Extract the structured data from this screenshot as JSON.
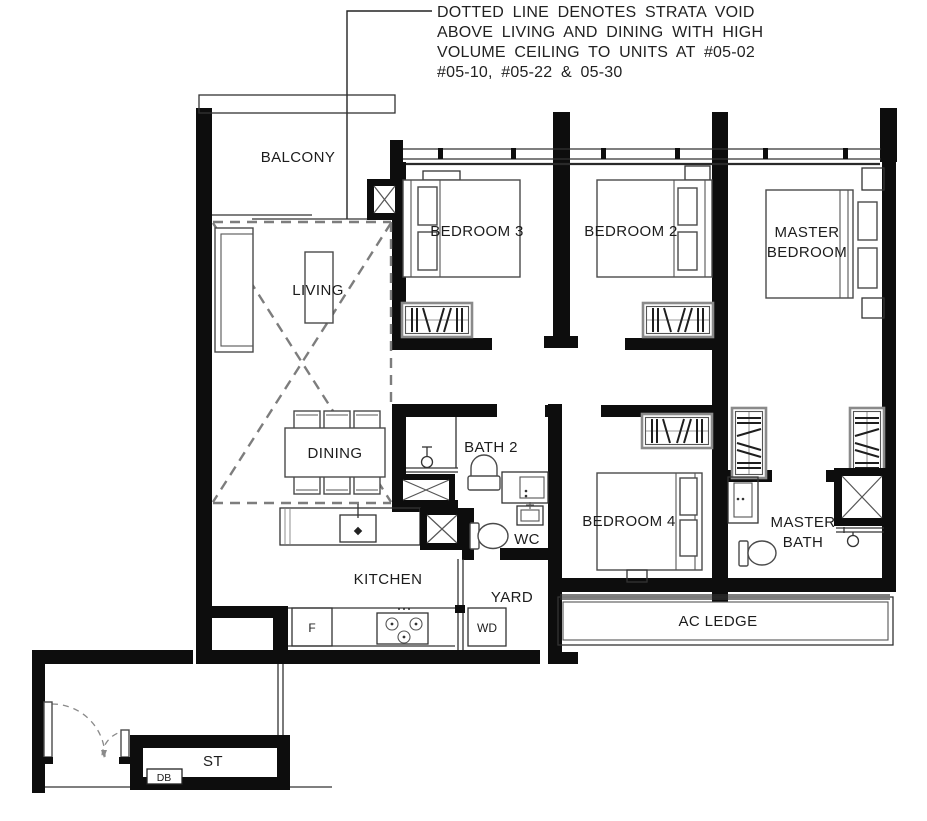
{
  "annotation": {
    "lines": [
      "DOTTED LINE DENOTES STRATA VOID",
      "ABOVE LIVING AND DINING WITH HIGH",
      "VOLUME CEILING TO UNITS AT #05-02",
      "#05-10, #05-22 & 05-30"
    ]
  },
  "rooms": {
    "balcony": "BALCONY",
    "living": "LIVING",
    "dining": "DINING",
    "kitchen": "KITCHEN",
    "yard": "YARD",
    "bath2": "BATH 2",
    "wc": "WC",
    "bedroom3": "BEDROOM 3",
    "bedroom2": "BEDROOM 2",
    "bedroom4": "BEDROOM 4",
    "master_bedroom": {
      "line1": "MASTER",
      "line2": "BEDROOM"
    },
    "master_bath": {
      "line1": "MASTER",
      "line2": "BATH"
    },
    "ac_ledge": "AC LEDGE",
    "store": "ST"
  },
  "appliances": {
    "fridge": "F",
    "washer_dryer": "WD",
    "distribution_board": "DB"
  },
  "colors": {
    "wall": "#0d0d0d",
    "line": "#3a3a3a",
    "void_dash": "#7d7d7d",
    "background": "#ffffff"
  }
}
